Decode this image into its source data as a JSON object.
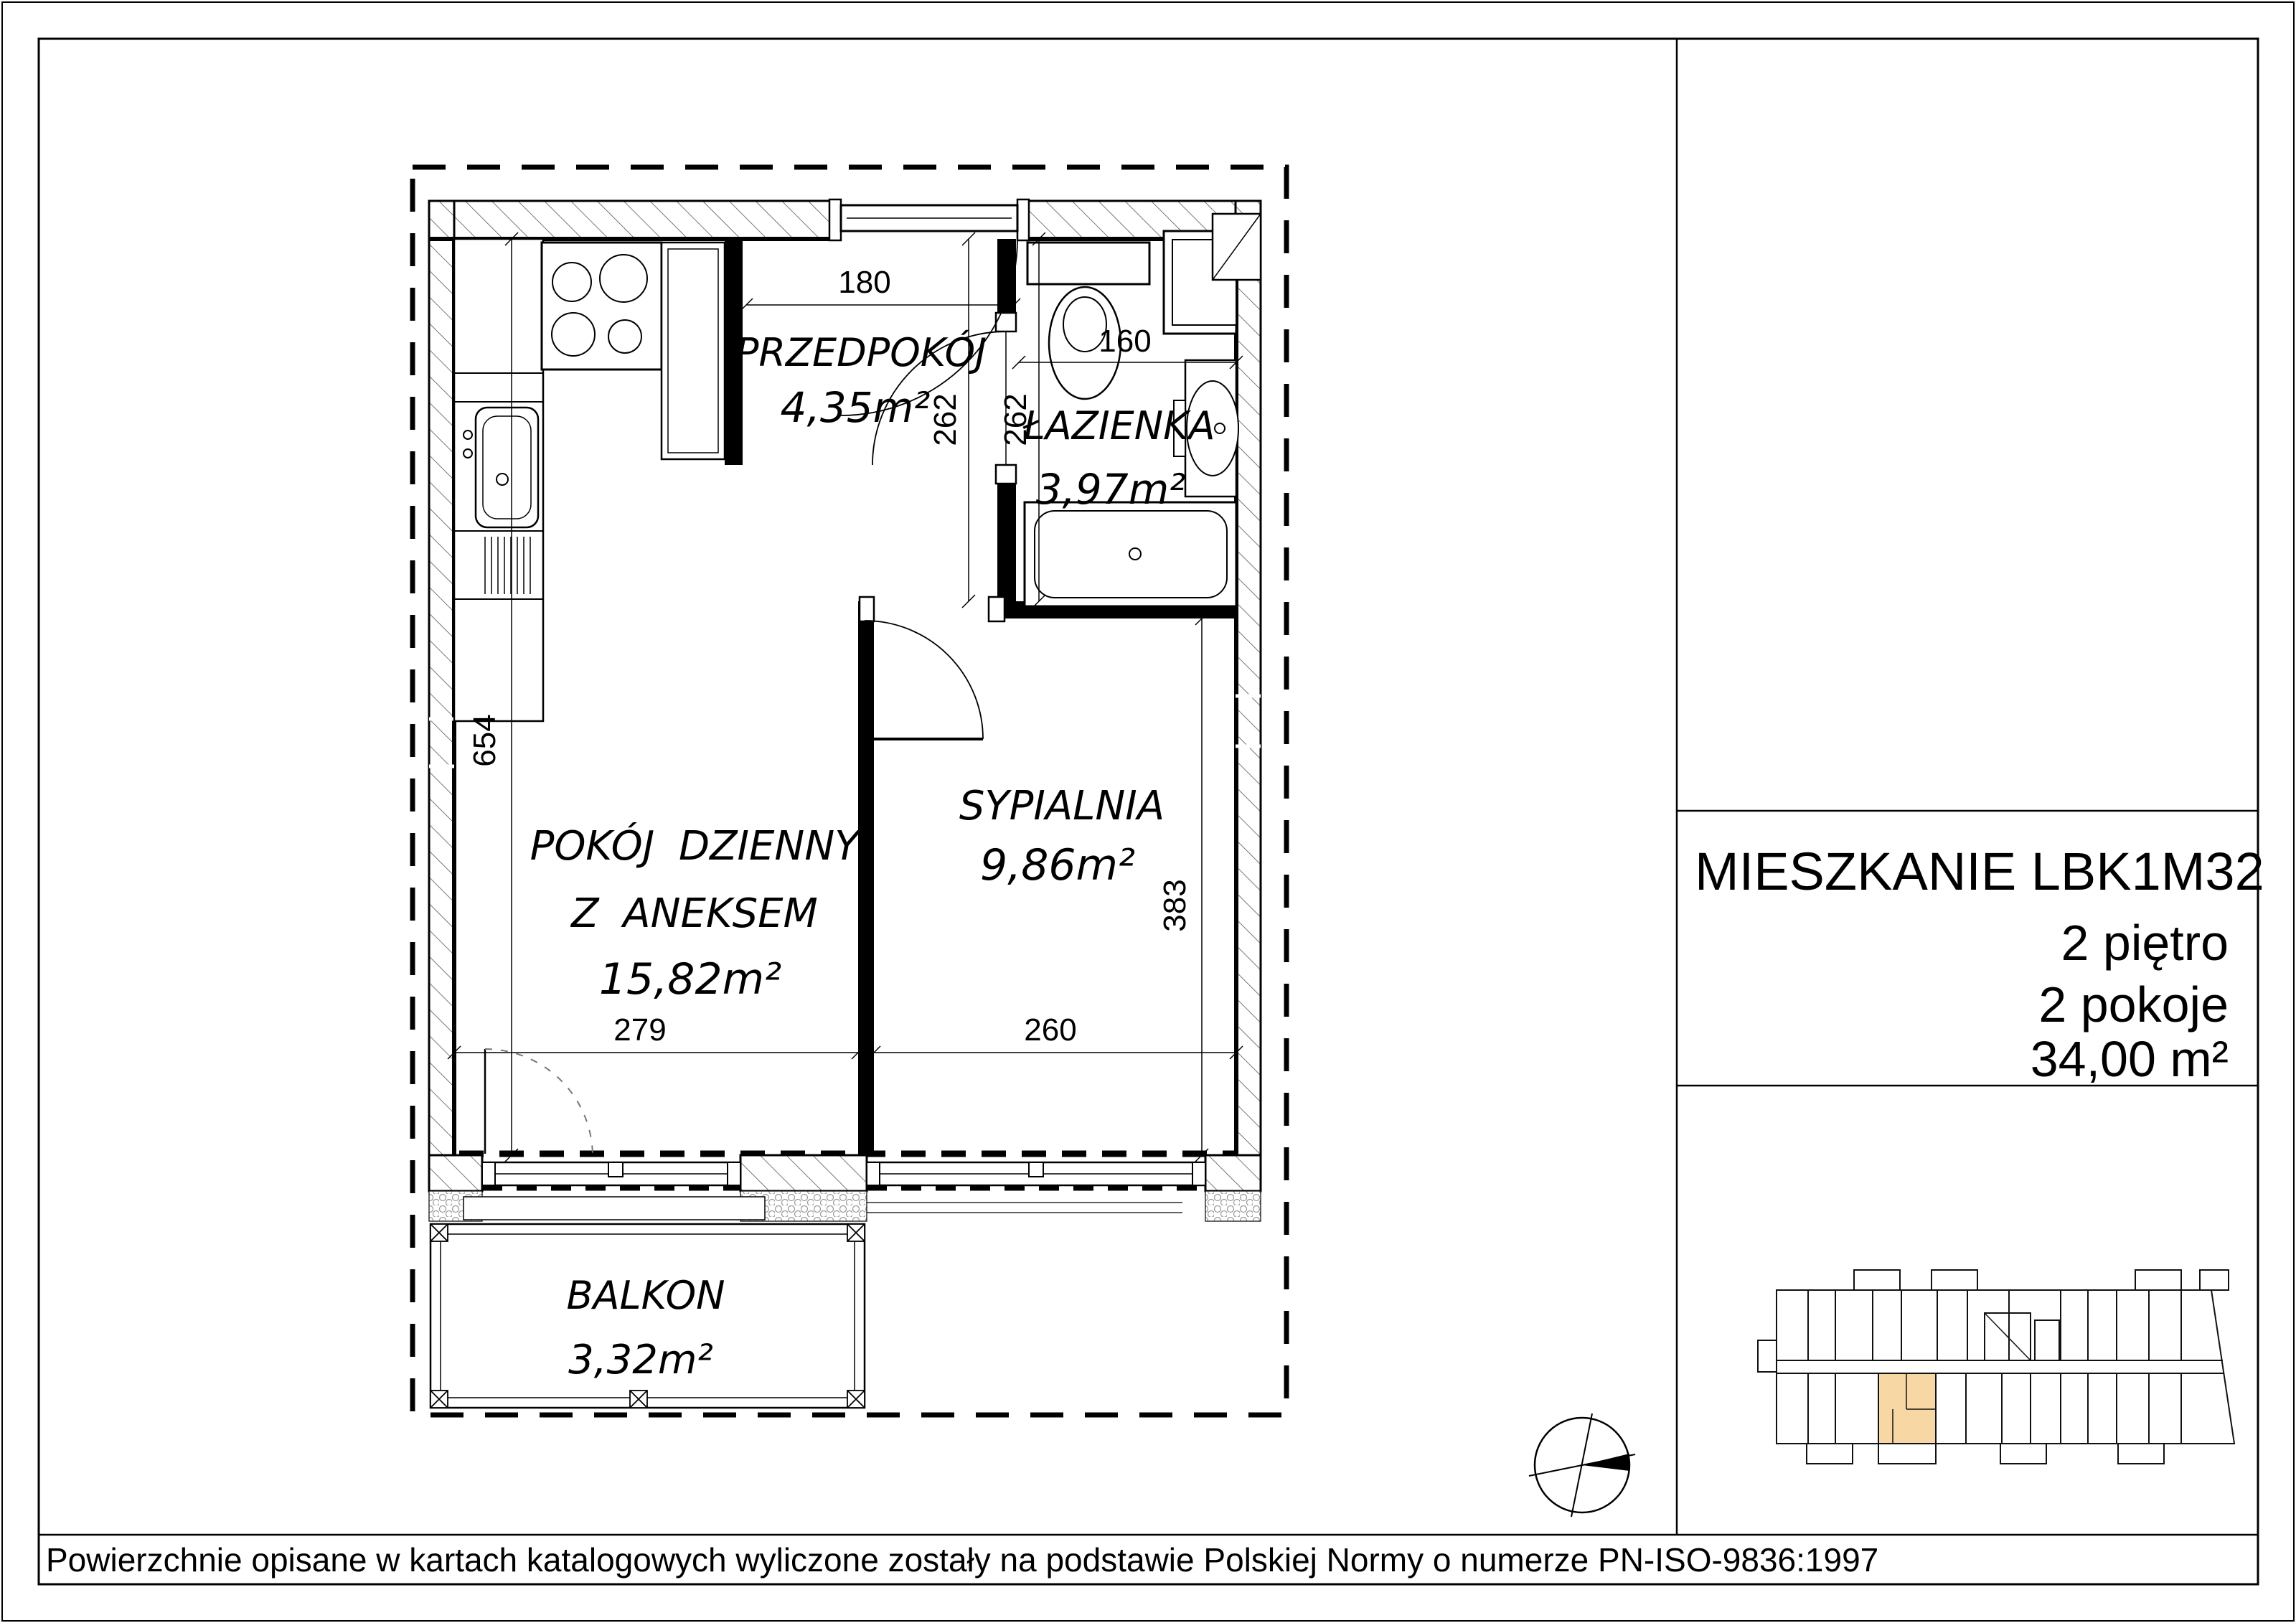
{
  "floor_plan": {
    "rooms": {
      "hallway": {
        "name": "PRZEDPOKÓJ",
        "area": "4,35m²"
      },
      "bathroom": {
        "name": "ŁAZIENKA",
        "area": "3,97m²"
      },
      "living": {
        "name_line1": "POKÓJ DZIENNY",
        "name_line2": "Z ANEKSEM",
        "area": "15,82m²"
      },
      "bedroom": {
        "name": "SYPIALNIA",
        "area": "9,86m²"
      },
      "balcony": {
        "name": "BALKON",
        "area": "3,32m²"
      }
    },
    "dims": {
      "hall_width": "180",
      "bath_width": "160",
      "hall_depth": "262",
      "bath_depth": "262",
      "west_wall": "654",
      "bedroom_depth": "383",
      "living_width": "279",
      "bedroom_width": "260"
    }
  },
  "info_panel": {
    "title": "MIESZKANIE LBK1M32",
    "floor": "2 piętro",
    "rooms_count": "2 pokoje",
    "total_area": "34,00 m²"
  },
  "footer": {
    "note": "Powierzchnie opisane w kartach katalogowych wyliczone zostały na podstawie Polskiej Normy o numerze PN-ISO-9836:1997"
  },
  "colors": {
    "highlight": "#F7D7A4",
    "line": "#000000"
  }
}
